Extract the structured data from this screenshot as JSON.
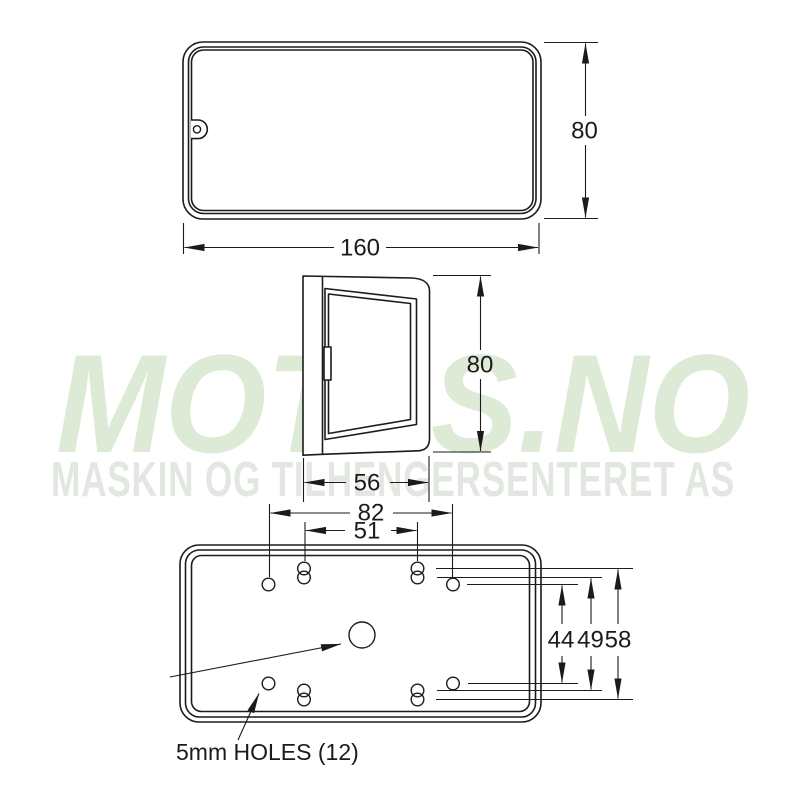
{
  "page": {
    "background_color": "#ffffff"
  },
  "watermark": {
    "title": "MOTAS.NO",
    "subtitle": "MASKIN OG TILHENGERSENTERET AS",
    "title_color": "#dcead6",
    "subtitle_color": "#e3e7e1"
  },
  "drawing": {
    "line_color": "#1b1b1b",
    "views": {
      "front": {
        "width": "160",
        "height": "80"
      },
      "side": {
        "depth": "56",
        "height": "80"
      },
      "back": {
        "hole_spacing_width_outer": "82",
        "keyhole_spacing_width": "51",
        "hole_spacing_height": "44",
        "keyhole_spacing_height_inner": "49",
        "keyhole_spacing_height_outer": "58",
        "holes_note": "5mm HOLES (12)"
      }
    }
  }
}
